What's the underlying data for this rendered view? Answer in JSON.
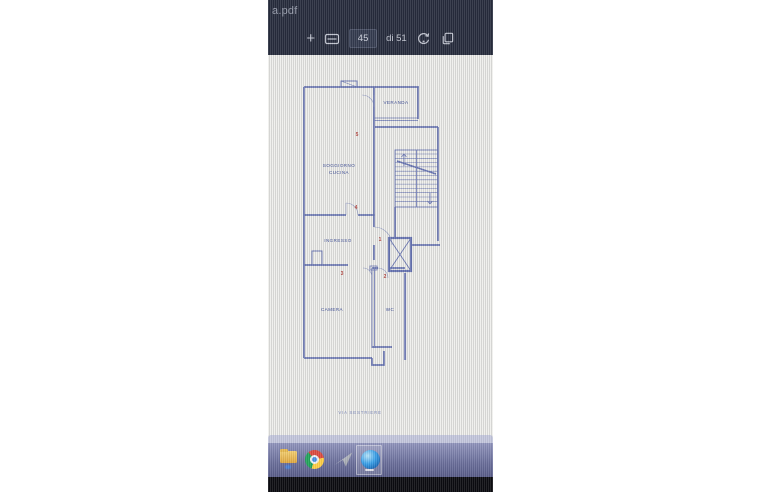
{
  "window": {
    "filename_fragment": "a.pdf"
  },
  "toolbar": {
    "zoom_in_label": "+",
    "current_page": "45",
    "page_count_label": "di 51",
    "icons": [
      "plus-icon",
      "fit-width-icon",
      "rotate-icon",
      "pages-icon"
    ]
  },
  "floor_plan": {
    "labels": {
      "veranda": "VERANDA",
      "soggiorno_line1": "SOGGIORNO",
      "soggiorno_line2": "CUCINA",
      "ingresso": "INGRESSO",
      "camera": "CAMERA",
      "wc": "WC"
    },
    "markers": {
      "n1": "1",
      "n2": "2",
      "n3": "3",
      "n4": "4",
      "n5": "5"
    },
    "street_label": "VIA SESTRIERE"
  },
  "taskbar": {
    "icons": [
      "file-explorer-icon",
      "chrome-icon",
      "photos-icon",
      "edge-icon"
    ],
    "active_app_index": 3
  },
  "colors": {
    "header_bg": "#272c3d",
    "blueprint_line": "#5664aa",
    "label_blue": "#3c4c94",
    "marker_red": "#b0403a",
    "paper": "#e9e9e7",
    "taskbar_top": "#9094bc",
    "taskbar_bottom": "#585c88",
    "bezel_black": "#0c0c11"
  }
}
